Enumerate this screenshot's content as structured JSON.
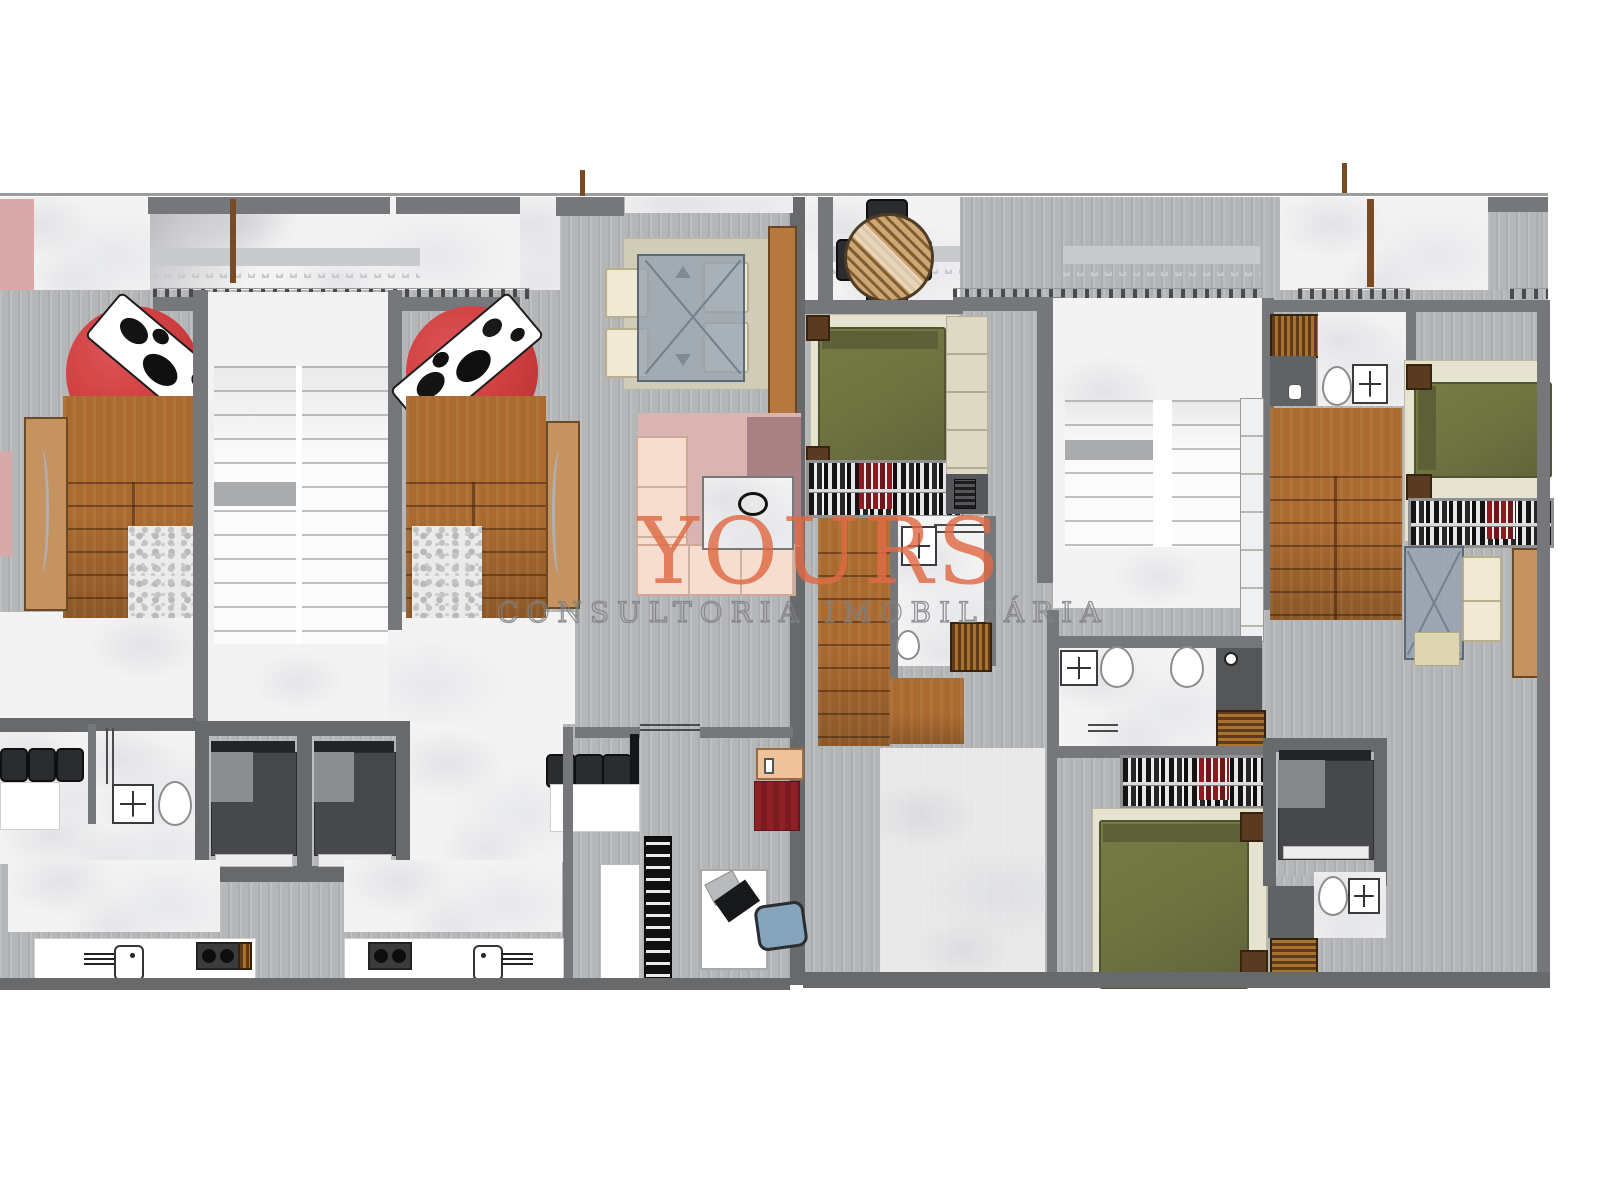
{
  "watermark": {
    "brand": "YOURS",
    "tagline": "CONSULTORIA IMOBILIÁRIA"
  },
  "palette": {
    "wall": "#75777a",
    "wall_dark": "#68696b",
    "floor": "#b5b6b8",
    "floor_light": "#c9cacc",
    "marble": "#f3f3f4",
    "wood": "#aa6a30",
    "wood_light": "#c4935f",
    "rug_red": "#d24042",
    "bed_green": "#6f7340",
    "bed_cream": "#e6e3d0",
    "bed_dark": "#46484b",
    "sofa_cream": "#f6ddcf",
    "rug_pink": "#dab4b1",
    "rug_mauve": "#a98084",
    "chair_cream": "#f0ead4",
    "stool_dark": "#2b2c2e",
    "chair_blue": "#86a5bc",
    "brand": "#e06a45",
    "tagline_gray": "#7f8184",
    "crimson_rug": "#8e2026",
    "table_beige": "#cfccb8"
  }
}
